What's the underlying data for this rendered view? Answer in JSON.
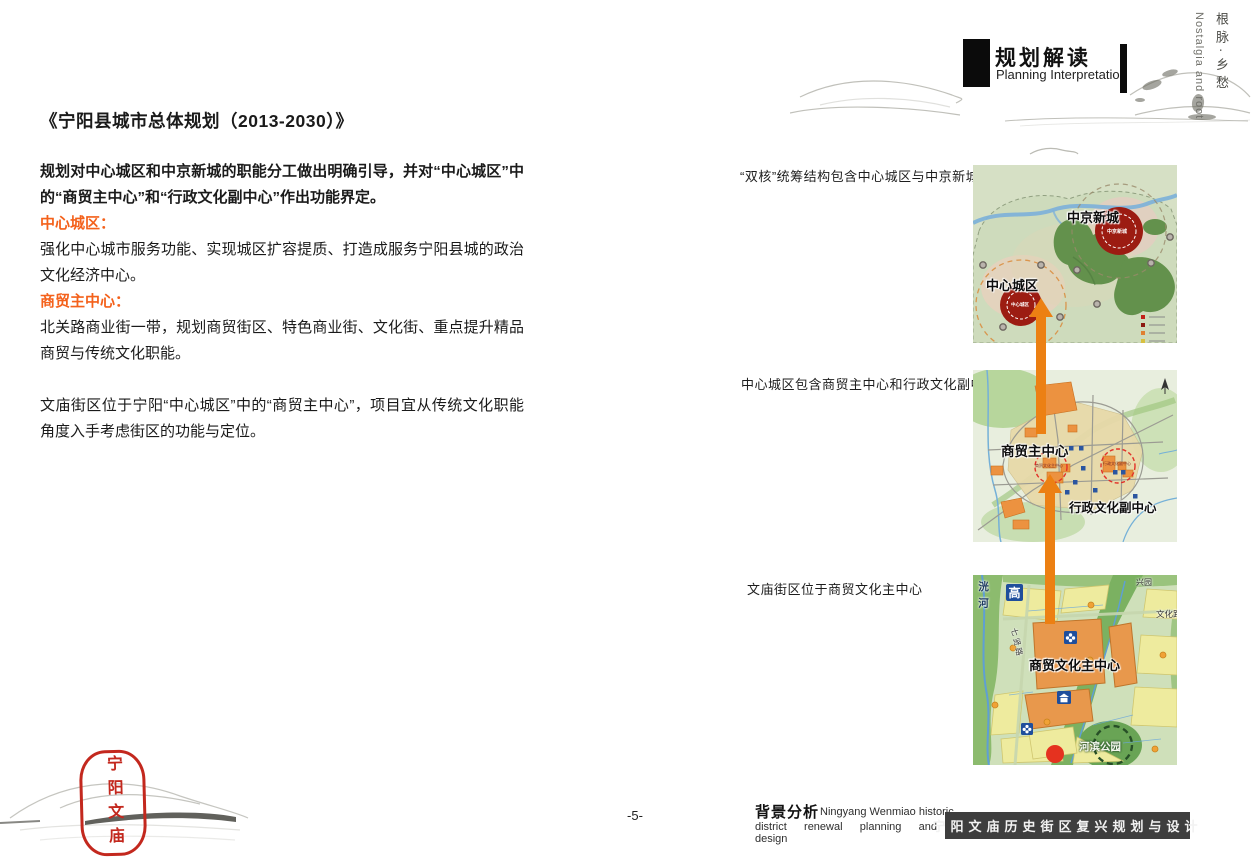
{
  "side": {
    "cn": "根脉·乡愁",
    "en": "Nostalgia and root"
  },
  "header": {
    "title_cn": "规划解读",
    "title_en": "Planning Interpretation"
  },
  "article": {
    "title": "《宁阳县城市总体规划（2013-2030）》",
    "intro": "规划对中心城区和中京新城的职能分工做出明确引导，并对“中心城区”中的“商贸主中心”和“行政文化副中心”作出功能界定。",
    "sections": [
      {
        "heading": "中心城区：",
        "body": "强化中心城市服务功能、实现城区扩容提质、打造成服务宁阳县城的政治文化经济中心。"
      },
      {
        "heading": "商贸主中心：",
        "body": "北关路商业街一带，规划商贸街区、特色商业街、文化街、重点提升精品商贸与传统文化职能。"
      }
    ],
    "conclusion": "文庙街区位于宁阳“中心城区”中的“商贸主中心”，项目宜从传统文化职能角度入手考虑街区的功能与定位。"
  },
  "figures": [
    {
      "caption": "“双核”统筹结构包含中心城区与中京新城",
      "label_right": "中京新城",
      "label_left": "中心城区"
    },
    {
      "caption": "中心城区包含商贸主中心和行政文化副中心",
      "label_main": "商贸主中心",
      "label_sub": "行政文化副中心",
      "small_main": "商贸文化主中心",
      "small_sub": "行政文化副中心"
    },
    {
      "caption": "文庙街区位于商贸文化主中心",
      "label_center": "商贸文化主中心",
      "label_park": "河滨公园",
      "river": "洸河",
      "sign": "高",
      "road_qixian": "七贤路",
      "road_wenhua": "文化路",
      "corner": "兴园"
    }
  ],
  "footer": {
    "page": "-5-",
    "section_cn": "背景分析",
    "en1": "Ningyang Wenmiao historic",
    "en2": "district renewal planning and design",
    "project": "宁阳文庙历史街区复兴规划与设计"
  },
  "seal": {
    "text": "宁阳文庙"
  },
  "colors": {
    "accent_orange": "#f4611b",
    "arrow_orange": "#ec8013",
    "core_red": "#9c1c12",
    "bar_gray": "#3e3e3e",
    "seal_red": "#c3281e"
  }
}
